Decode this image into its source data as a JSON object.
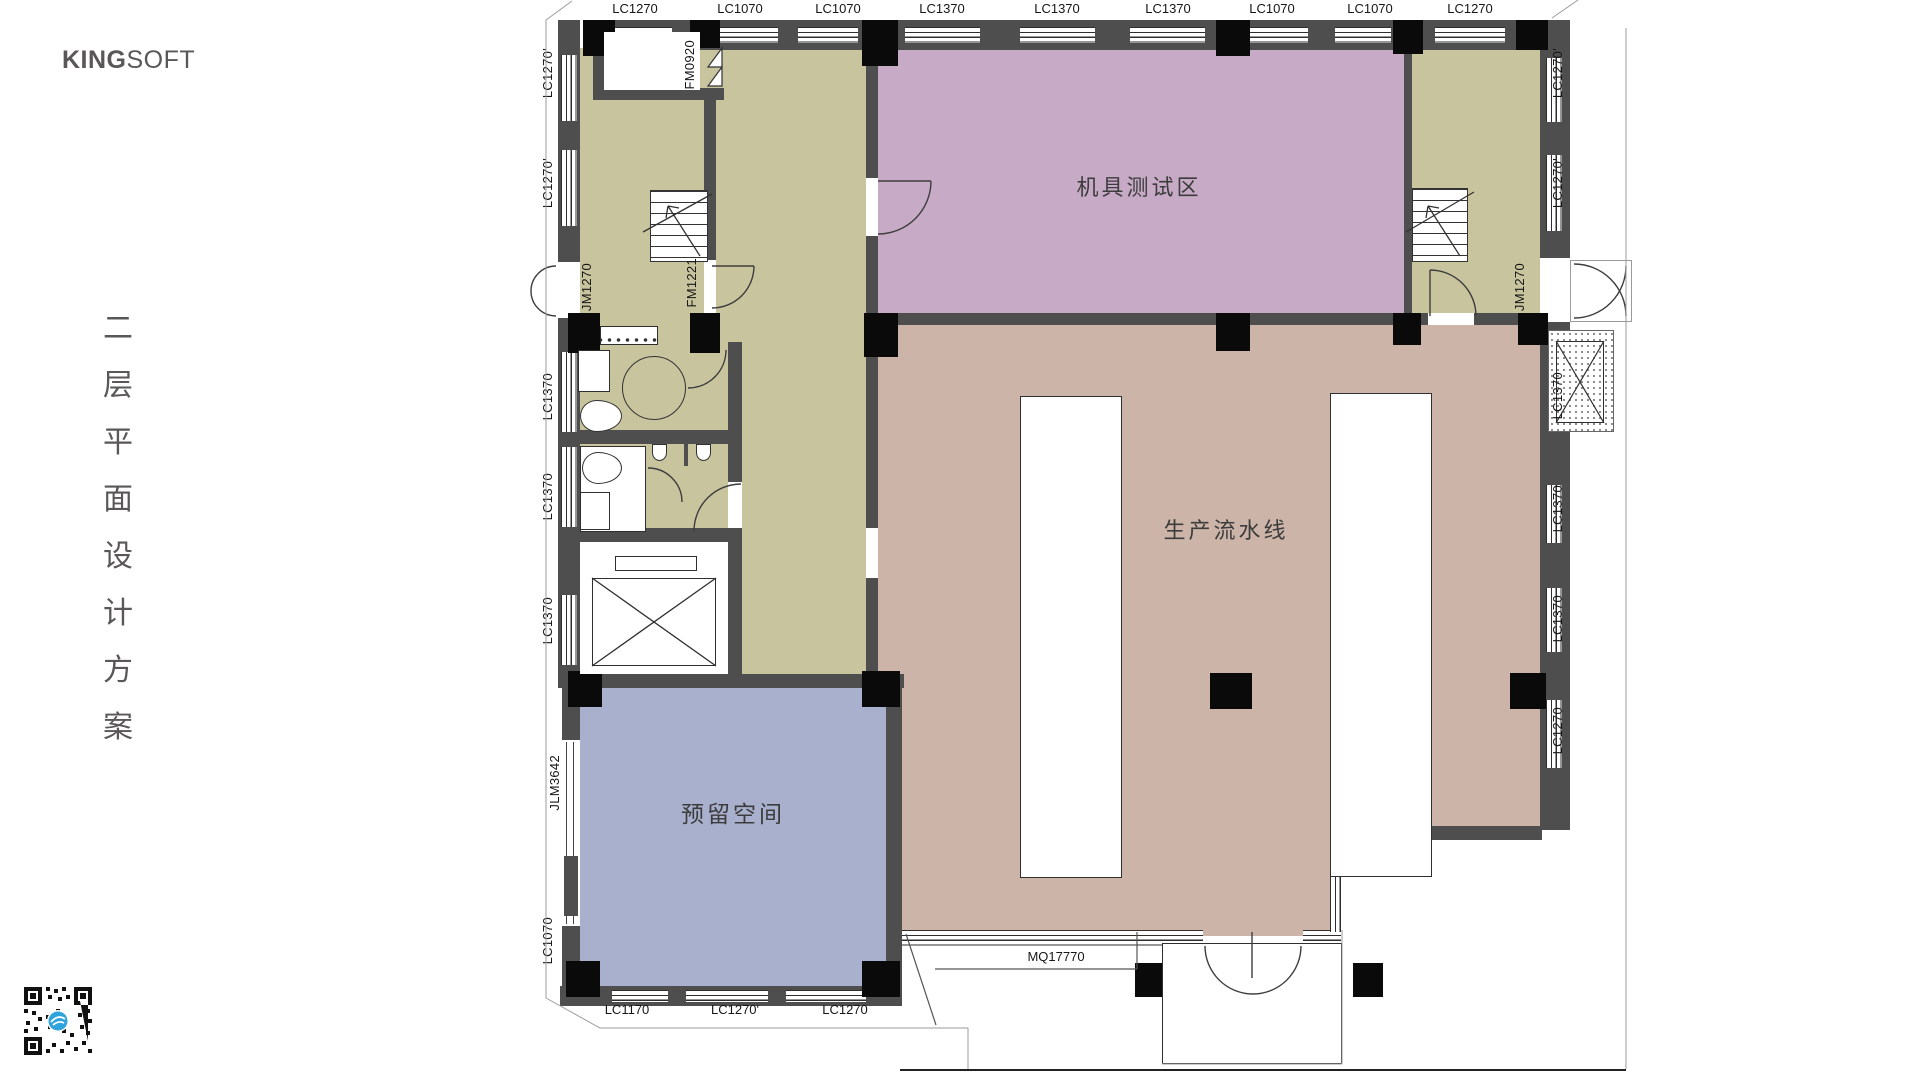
{
  "brand": {
    "bold": "KING",
    "light": "SOFT"
  },
  "title_vertical": {
    "text": "二层平面设计方案",
    "chars": [
      "二",
      "层",
      "平",
      "面",
      "设",
      "计",
      "方",
      "案"
    ]
  },
  "plan": {
    "room_labels": {
      "testing": "机具测试区",
      "production": "生产流水线",
      "reserved": "预留空间"
    },
    "top_labels": [
      "LC1270",
      "LC1070",
      "LC1070",
      "LC1370",
      "LC1370",
      "LC1370",
      "LC1070",
      "LC1070",
      "LC1270"
    ],
    "left_labels": [
      "LC1270'",
      "LC1270'",
      "JM1270",
      "LC1370",
      "LC1370",
      "LC1370",
      "JLM3642",
      "LC1070"
    ],
    "right_labels": [
      "LC1270'",
      "LC1270'",
      "JM1270",
      "LC1370",
      "LC1370",
      "LC1370",
      "LC1270"
    ],
    "bottom_labels": [
      "LC1170",
      "LC1270'",
      "LC1270"
    ],
    "curtain_wall_label": "MQ17770",
    "door_labels": {
      "vestibule_door": "FM0920",
      "stair_door": "FM1221"
    },
    "colors": {
      "corridor": "#c8c49e",
      "testing": "#c7aac6",
      "production": "#ccb4a8",
      "reserved": "#a9b0ce",
      "wall": "#4f4e4e",
      "column": "#0a0a0a",
      "qr_logo": "#2ea3dc"
    }
  }
}
